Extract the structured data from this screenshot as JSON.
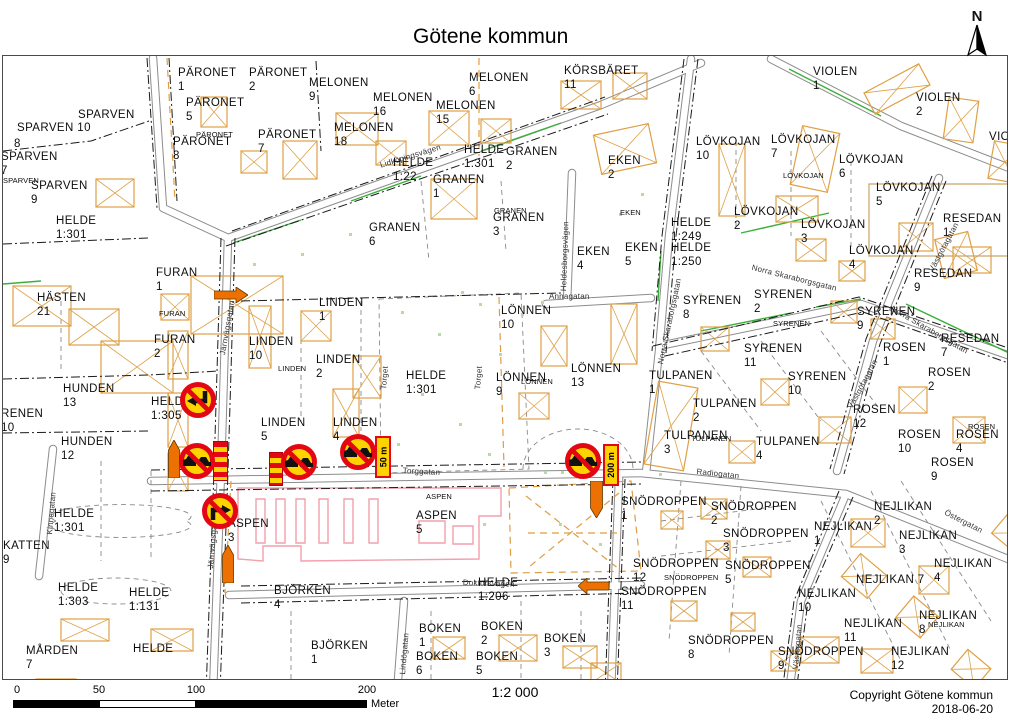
{
  "header": {
    "title": "Götene kommun"
  },
  "north": {
    "label": "N"
  },
  "scalebar": {
    "tick0": "0",
    "tick50": "50",
    "tick100": "100",
    "tick200": "200",
    "unit": "Meter"
  },
  "footer": {
    "scale_text": "1:2 000",
    "copyright": "Copyright Götene kommun",
    "date": "2018-06-20"
  },
  "colors": {
    "sign_red": "#E30613",
    "sign_yellow": "#FFD300",
    "work_orange": "#ED7102",
    "building_orange": "#DFA045",
    "aspen_pink": "#F2A0AC",
    "green": "#3BB039"
  },
  "map": {
    "labels": [
      {
        "t": "SPARVEN",
        "x": 77,
        "y": 108
      },
      {
        "t": "SPARVEN 10",
        "x": 16,
        "y": 121
      },
      {
        "t": "8",
        "x": 13,
        "y": 137
      },
      {
        "t": "SPARVEN\n7",
        "x": 0,
        "y": 150
      },
      {
        "t": "SPARVEN",
        "x": 2,
        "y": 176,
        "s": 1
      },
      {
        "t": "SPARVEN\n9",
        "x": 30,
        "y": 179
      },
      {
        "t": "PÄRONET\n1",
        "x": 177,
        "y": 66
      },
      {
        "t": "PÄRONET\n2",
        "x": 248,
        "y": 66
      },
      {
        "t": "PÄRONET\n5",
        "x": 185,
        "y": 96
      },
      {
        "t": "PÄRONET",
        "x": 195,
        "y": 130,
        "s": 1
      },
      {
        "t": "PÄRONET\n8",
        "x": 172,
        "y": 135
      },
      {
        "t": "PÄRONET\n7",
        "x": 257,
        "y": 128
      },
      {
        "t": "MELONEN\n9",
        "x": 308,
        "y": 76
      },
      {
        "t": "MELONEN\n16",
        "x": 372,
        "y": 91
      },
      {
        "t": "MELONEN\n15",
        "x": 435,
        "y": 99
      },
      {
        "t": "MELONEN\n6",
        "x": 468,
        "y": 71
      },
      {
        "t": "MELONEN\n18",
        "x": 333,
        "y": 121
      },
      {
        "t": "KÖRSBÄRET\n11",
        "x": 563,
        "y": 64
      },
      {
        "t": "HELDE\n1:301",
        "x": 55,
        "y": 214
      },
      {
        "t": "HELDE\n1:22",
        "x": 392,
        "y": 156
      },
      {
        "t": "Lidköpingsvägen",
        "x": 378,
        "y": 160,
        "st": 1,
        "r": -17
      },
      {
        "t": "HELDE\n1:301",
        "x": 463,
        "y": 143
      },
      {
        "t": "GRANEN\n2",
        "x": 505,
        "y": 145
      },
      {
        "t": "GRANEN\n1",
        "x": 432,
        "y": 173
      },
      {
        "t": "GRANEN\n6",
        "x": 368,
        "y": 221
      },
      {
        "t": "GRANEN",
        "x": 493,
        "y": 206,
        "s": 1
      },
      {
        "t": "GRANEN\n3",
        "x": 492,
        "y": 211
      },
      {
        "t": "EKEN\n2",
        "x": 607,
        "y": 154
      },
      {
        "t": "EKEN",
        "x": 619,
        "y": 208,
        "s": 1
      },
      {
        "t": "EKEN\n4",
        "x": 576,
        "y": 245
      },
      {
        "t": "EKEN\n5",
        "x": 624,
        "y": 241
      },
      {
        "t": "Heldesborgsvägen",
        "x": 558,
        "y": 290,
        "st": 1,
        "r": -88
      },
      {
        "t": "VIOLEN\n1",
        "x": 812,
        "y": 65
      },
      {
        "t": "VIOLEN\n2",
        "x": 915,
        "y": 91
      },
      {
        "t": "VIOLEN",
        "x": 988,
        "y": 130
      },
      {
        "t": "LÖVKOJAN\n10",
        "x": 695,
        "y": 135
      },
      {
        "t": "LÖVKOJAN\n7",
        "x": 770,
        "y": 133
      },
      {
        "t": "LÖVKOJAN\n6",
        "x": 838,
        "y": 153
      },
      {
        "t": "LÖVKOJAN",
        "x": 782,
        "y": 171,
        "s": 1
      },
      {
        "t": "LÖVKOJAN\n5",
        "x": 875,
        "y": 181
      },
      {
        "t": "LÖVKOJAN\n2",
        "x": 733,
        "y": 205
      },
      {
        "t": "LÖVKOJAN\n3",
        "x": 800,
        "y": 218
      },
      {
        "t": "LÖVKOJAN\n4",
        "x": 848,
        "y": 244
      },
      {
        "t": "HELDE\n1:249",
        "x": 670,
        "y": 216
      },
      {
        "t": "HELDE\n1:250",
        "x": 670,
        "y": 241
      },
      {
        "t": "RESEDAN\n1",
        "x": 942,
        "y": 212
      },
      {
        "t": "RESEDAN\n9",
        "x": 913,
        "y": 267
      },
      {
        "t": "RESEDAN\n7",
        "x": 940,
        "y": 332
      },
      {
        "t": "Norra Skaraborgsgatan",
        "x": 752,
        "y": 262,
        "st": 1,
        "r": 14
      },
      {
        "t": "Västgötagatan",
        "x": 926,
        "y": 268,
        "st": 1,
        "r": -62
      },
      {
        "t": "Västgötagatan",
        "x": 845,
        "y": 405,
        "st": 1,
        "r": -62
      },
      {
        "t": "HÄSTEN\n21",
        "x": 36,
        "y": 291
      },
      {
        "t": "FURAN\n1",
        "x": 155,
        "y": 266
      },
      {
        "t": "FURAN",
        "x": 158,
        "y": 309,
        "s": 1
      },
      {
        "t": "FURAN\n2",
        "x": 153,
        "y": 333
      },
      {
        "t": "HUNDEN\n13",
        "x": 62,
        "y": 382
      },
      {
        "t": "RENEN\n10",
        "x": 0,
        "y": 407
      },
      {
        "t": "HUNDEN\n12",
        "x": 60,
        "y": 435
      },
      {
        "t": "HELDE\n1:305",
        "x": 150,
        "y": 395
      },
      {
        "t": "Järnvägsgatan",
        "x": 217,
        "y": 353,
        "st": 1,
        "r": -80
      },
      {
        "t": "LINDEN\n1",
        "x": 318,
        "y": 296
      },
      {
        "t": "LINDEN\n10",
        "x": 248,
        "y": 335
      },
      {
        "t": "LINDEN",
        "x": 277,
        "y": 364,
        "s": 1
      },
      {
        "t": "LINDEN\n2",
        "x": 315,
        "y": 353
      },
      {
        "t": "LINDEN\n5",
        "x": 260,
        "y": 416
      },
      {
        "t": "LINDEN\n4",
        "x": 332,
        "y": 416
      },
      {
        "t": "HELDE\n1:301",
        "x": 405,
        "y": 369
      },
      {
        "t": "Torget",
        "x": 378,
        "y": 388,
        "st": 1,
        "r": -85
      },
      {
        "t": "Torget",
        "x": 472,
        "y": 388,
        "st": 1,
        "r": -85
      },
      {
        "t": "LÖNNEN\n10",
        "x": 500,
        "y": 304
      },
      {
        "t": "LÖNNEN\n9",
        "x": 495,
        "y": 371
      },
      {
        "t": "LÖNNEN",
        "x": 520,
        "y": 377,
        "s": 1
      },
      {
        "t": "LÖNNEN\n13",
        "x": 570,
        "y": 362
      },
      {
        "t": "Annagatan",
        "x": 548,
        "y": 291,
        "st": 1
      },
      {
        "t": "SYRENEN\n8",
        "x": 682,
        "y": 294
      },
      {
        "t": "SYRENEN\n2",
        "x": 753,
        "y": 288
      },
      {
        "t": "SYRENEN\n9",
        "x": 856,
        "y": 305
      },
      {
        "t": "SYRENEN",
        "x": 772,
        "y": 319,
        "s": 1
      },
      {
        "t": "SYRENEN\n11",
        "x": 743,
        "y": 342
      },
      {
        "t": "SYRENEN\n10",
        "x": 787,
        "y": 370
      },
      {
        "t": "Norra Skaraborgsgatan",
        "x": 655,
        "y": 362,
        "st": 1,
        "r": -78
      },
      {
        "t": "TULPANEN\n1",
        "x": 648,
        "y": 369
      },
      {
        "t": "TULPANEN\n2",
        "x": 692,
        "y": 397
      },
      {
        "t": "TULPANEN\n3",
        "x": 663,
        "y": 429
      },
      {
        "t": "TULPANEN",
        "x": 690,
        "y": 434,
        "s": 1
      },
      {
        "t": "TULPANEN\n4",
        "x": 755,
        "y": 435
      },
      {
        "t": "Radiogatan",
        "x": 696,
        "y": 466,
        "st": 1,
        "r": 6
      },
      {
        "t": "Norra Skaraborgsgatan",
        "x": 893,
        "y": 303,
        "st": 1,
        "r": 30
      },
      {
        "t": "ROSEN\n1",
        "x": 882,
        "y": 341
      },
      {
        "t": "ROSEN\n2",
        "x": 927,
        "y": 366
      },
      {
        "t": "ROSEN\n12",
        "x": 852,
        "y": 403
      },
      {
        "t": "ROSEN\n10",
        "x": 897,
        "y": 428
      },
      {
        "t": "ROSEN\n4",
        "x": 955,
        "y": 428
      },
      {
        "t": "ROSEN",
        "x": 967,
        "y": 422,
        "s": 1
      },
      {
        "t": "ROSEN\n9",
        "x": 930,
        "y": 456
      },
      {
        "t": "HELDE\n1:301",
        "x": 53,
        "y": 507
      },
      {
        "t": "Kinnegatan",
        "x": 44,
        "y": 533,
        "st": 1,
        "r": -85
      },
      {
        "t": "KATTEN\n9",
        "x": 2,
        "y": 539
      },
      {
        "t": "HELDE\n1:303",
        "x": 57,
        "y": 581
      },
      {
        "t": "HELDE\n1:131",
        "x": 128,
        "y": 586
      },
      {
        "t": "MÅRDEN\n7",
        "x": 25,
        "y": 644
      },
      {
        "t": "HELDE",
        "x": 132,
        "y": 642
      },
      {
        "t": "ASPEN\n3",
        "x": 227,
        "y": 517
      },
      {
        "t": "Järnvägsgatan",
        "x": 205,
        "y": 567,
        "st": 1,
        "r": -85
      },
      {
        "t": "BJÖRKEN\n4",
        "x": 273,
        "y": 584
      },
      {
        "t": "ASPEN",
        "x": 425,
        "y": 492,
        "s": 1
      },
      {
        "t": "ASPEN\n5",
        "x": 415,
        "y": 509
      },
      {
        "t": "BJÖRKEN\n1",
        "x": 310,
        "y": 639
      },
      {
        "t": "BOKEN\n1",
        "x": 418,
        "y": 622
      },
      {
        "t": "BOKEN\n6",
        "x": 415,
        "y": 650
      },
      {
        "t": "BOKEN\n2",
        "x": 480,
        "y": 620
      },
      {
        "t": "BOKEN\n5",
        "x": 475,
        "y": 650
      },
      {
        "t": "BOKEN\n3",
        "x": 543,
        "y": 632
      },
      {
        "t": "HELDE\n1:206",
        "x": 477,
        "y": 576
      },
      {
        "t": "Lindögatan",
        "x": 397,
        "y": 673,
        "st": 1,
        "r": -85
      },
      {
        "t": "Doktorsvägen",
        "x": 462,
        "y": 577,
        "st": 1,
        "r": 2
      },
      {
        "t": "Torggatan",
        "x": 402,
        "y": 465,
        "st": 1,
        "r": 3
      },
      {
        "t": "SNÖDROPPEN\n1",
        "x": 620,
        "y": 495
      },
      {
        "t": "SNÖDROPPEN\n2",
        "x": 710,
        "y": 500
      },
      {
        "t": "SNÖDROPPEN\n3",
        "x": 722,
        "y": 527
      },
      {
        "t": "SNÖDROPPEN\n12",
        "x": 632,
        "y": 557
      },
      {
        "t": "SNÖDROPPEN",
        "x": 663,
        "y": 573,
        "s": 1
      },
      {
        "t": "SNÖDROPPEN\n5",
        "x": 724,
        "y": 559
      },
      {
        "t": "SNÖDROPPEN\n11",
        "x": 620,
        "y": 585
      },
      {
        "t": "SNÖDROPPEN\n8",
        "x": 687,
        "y": 634
      },
      {
        "t": "SNÖDROPPEN\n9",
        "x": 777,
        "y": 645
      },
      {
        "t": "NEJLIKAN\n1",
        "x": 813,
        "y": 520
      },
      {
        "t": "NEJLIKAN\n2",
        "x": 873,
        "y": 500
      },
      {
        "t": "NEJLIKAN\n3",
        "x": 898,
        "y": 529
      },
      {
        "t": "NEJLIKAN\n4",
        "x": 933,
        "y": 557
      },
      {
        "t": "NEJLIKAN 7",
        "x": 855,
        "y": 573
      },
      {
        "t": "NEJLIKAN\n10",
        "x": 797,
        "y": 587
      },
      {
        "t": "NEJLIKAN\n11",
        "x": 843,
        "y": 617
      },
      {
        "t": "NEJLIKAN\n8",
        "x": 918,
        "y": 609
      },
      {
        "t": "NEJLIKAN",
        "x": 927,
        "y": 620,
        "s": 1
      },
      {
        "t": "NEJLIKAN\n12",
        "x": 890,
        "y": 645
      },
      {
        "t": "Östergatan",
        "x": 946,
        "y": 507,
        "st": 1,
        "r": 27
      },
      {
        "t": "Västergatan",
        "x": 790,
        "y": 668,
        "st": 1,
        "r": -85
      }
    ],
    "roadwork": {
      "signs": [
        {
          "name": "no-left-turn-sign",
          "type": "no-left-turn",
          "x": 197,
          "y": 399
        },
        {
          "name": "no-overtaking-sign",
          "type": "no-overtaking",
          "x": 196,
          "y": 460
        },
        {
          "name": "no-overtaking-sign",
          "type": "no-overtaking",
          "x": 298,
          "y": 461
        },
        {
          "name": "no-overtaking-sign",
          "type": "no-overtaking",
          "x": 357,
          "y": 451
        },
        {
          "name": "no-right-turn-sign",
          "type": "no-right-turn",
          "x": 219,
          "y": 510
        },
        {
          "name": "no-overtaking-sign",
          "type": "no-overtaking",
          "x": 582,
          "y": 460
        }
      ],
      "plates": [
        {
          "text": "50 m",
          "x": 382,
          "y": 456
        },
        {
          "text": "200 m",
          "x": 610,
          "y": 464
        }
      ],
      "arrows": [
        {
          "dir": "right",
          "x": 230,
          "y": 294
        },
        {
          "dir": "up",
          "x": 173,
          "y": 458
        },
        {
          "dir": "up",
          "x": 227,
          "y": 563
        },
        {
          "dir": "down",
          "x": 595,
          "y": 498
        },
        {
          "dir": "left",
          "x": 592,
          "y": 585
        }
      ],
      "barriers": [
        {
          "x": 218,
          "y": 459,
          "w": 13,
          "h": 38
        },
        {
          "x": 274,
          "y": 467,
          "w": 12,
          "h": 32
        }
      ]
    }
  }
}
